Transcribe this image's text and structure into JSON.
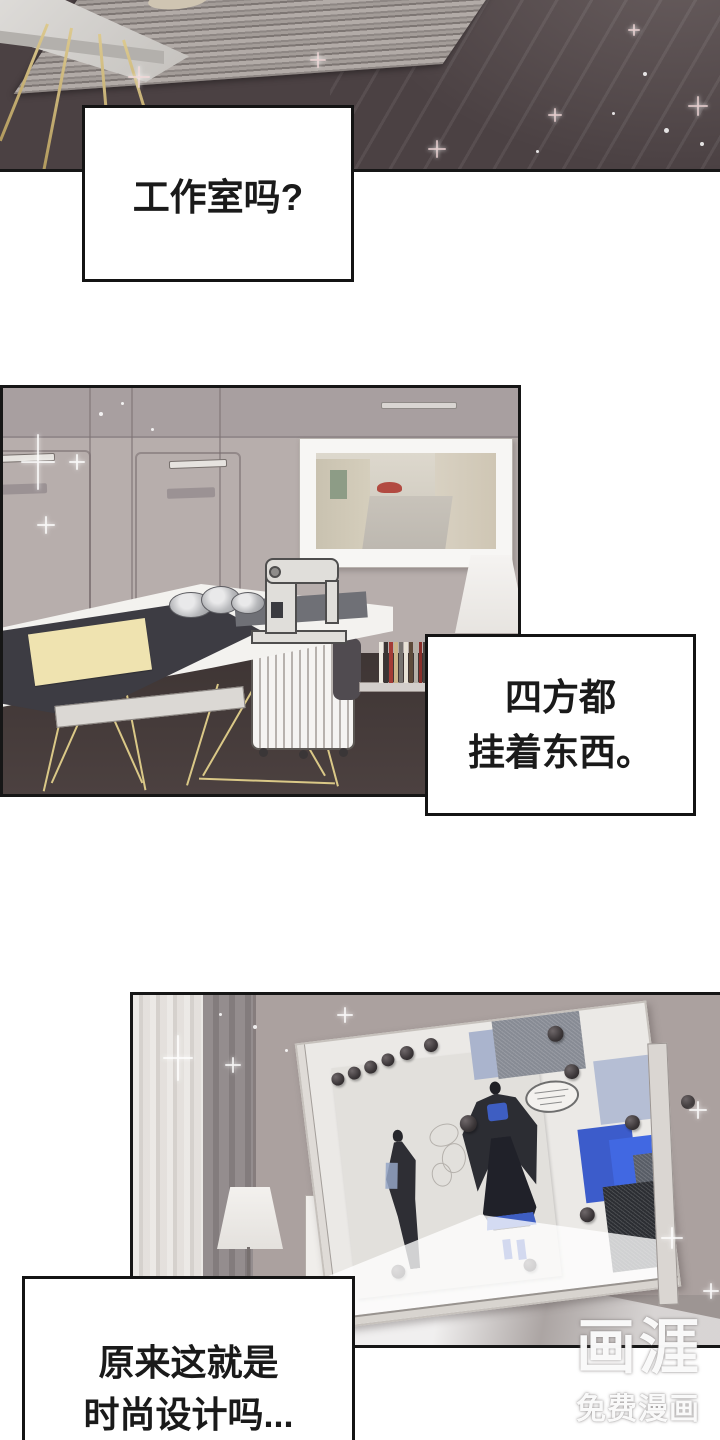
{
  "comic": {
    "speech_boxes": [
      {
        "id": "box-1",
        "lines": [
          "工作室吗?"
        ]
      },
      {
        "id": "box-2",
        "lines": [
          "四方都",
          "挂着东西。"
        ]
      },
      {
        "id": "box-3",
        "lines": [
          "原来这就是",
          "时尚设计吗..."
        ]
      }
    ]
  },
  "watermark": {
    "logo": "画涯",
    "tagline": "免费漫画"
  },
  "colors": {
    "panel_border": "#161616",
    "text": "#1a1a1a",
    "wall_taupe": "#b7aeac",
    "dark_floor": "#4b4143",
    "gold_legs": "#dac887",
    "accent_blue": "#3e5ec2",
    "paper_cream": "#efe3b0"
  }
}
